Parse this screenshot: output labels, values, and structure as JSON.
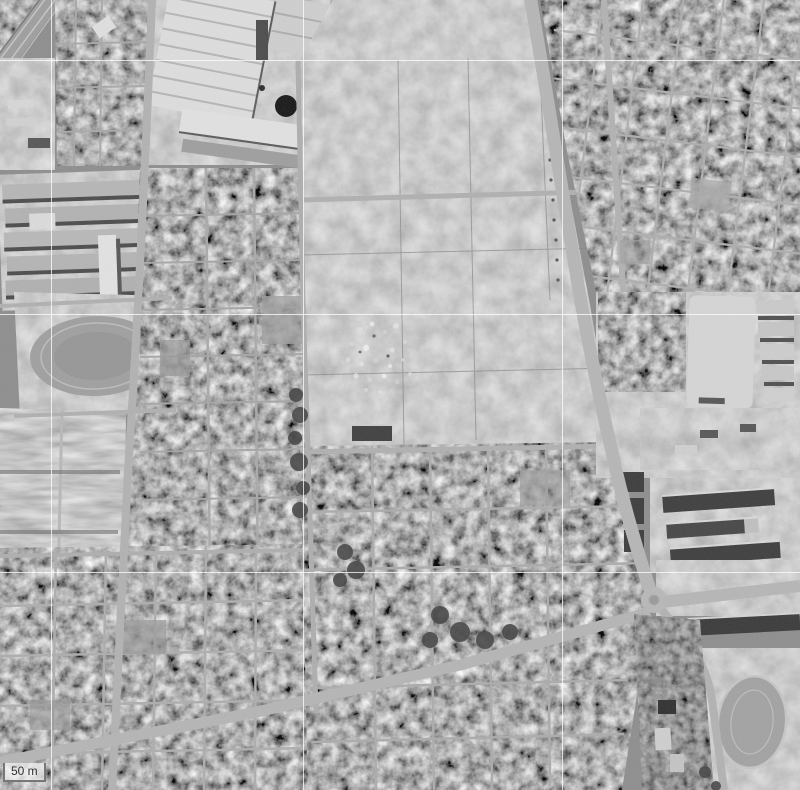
{
  "scale_control": {
    "label": "50 m"
  },
  "grid": {
    "color": "#ffffff",
    "opacity": 0.75,
    "vertical_x": [
      51,
      303,
      562
    ],
    "horizontal_y": [
      60,
      314,
      572
    ]
  },
  "photo": {
    "base_color": "#8d8d8d",
    "road_color": "#b5b5b5",
    "grid_line_count": 6
  }
}
